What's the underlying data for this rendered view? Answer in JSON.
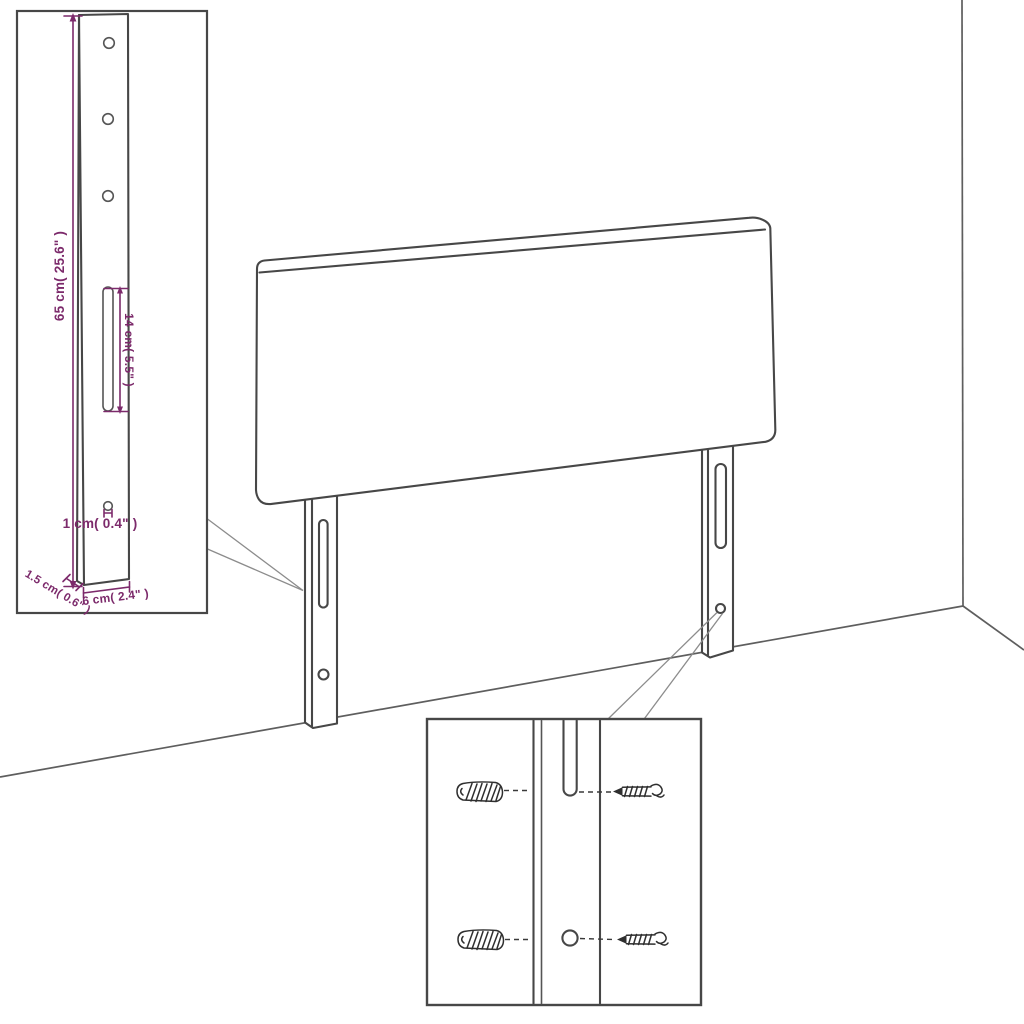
{
  "colors": {
    "background": "#ffffff",
    "drawing_outline": "#474747",
    "wall_line": "#5e5e5e",
    "dimension_accent": "#7c2a6b"
  },
  "leg_detail": {
    "height_label": "65 cm( 25.6\" )",
    "slot_length_label": "14 cm( 5.5\" )",
    "hole_label": "1 cm( 0.4\" )",
    "thickness_label": "1.5 cm( 0.6\" )",
    "width_label": "6 cm( 2.4\" )"
  }
}
